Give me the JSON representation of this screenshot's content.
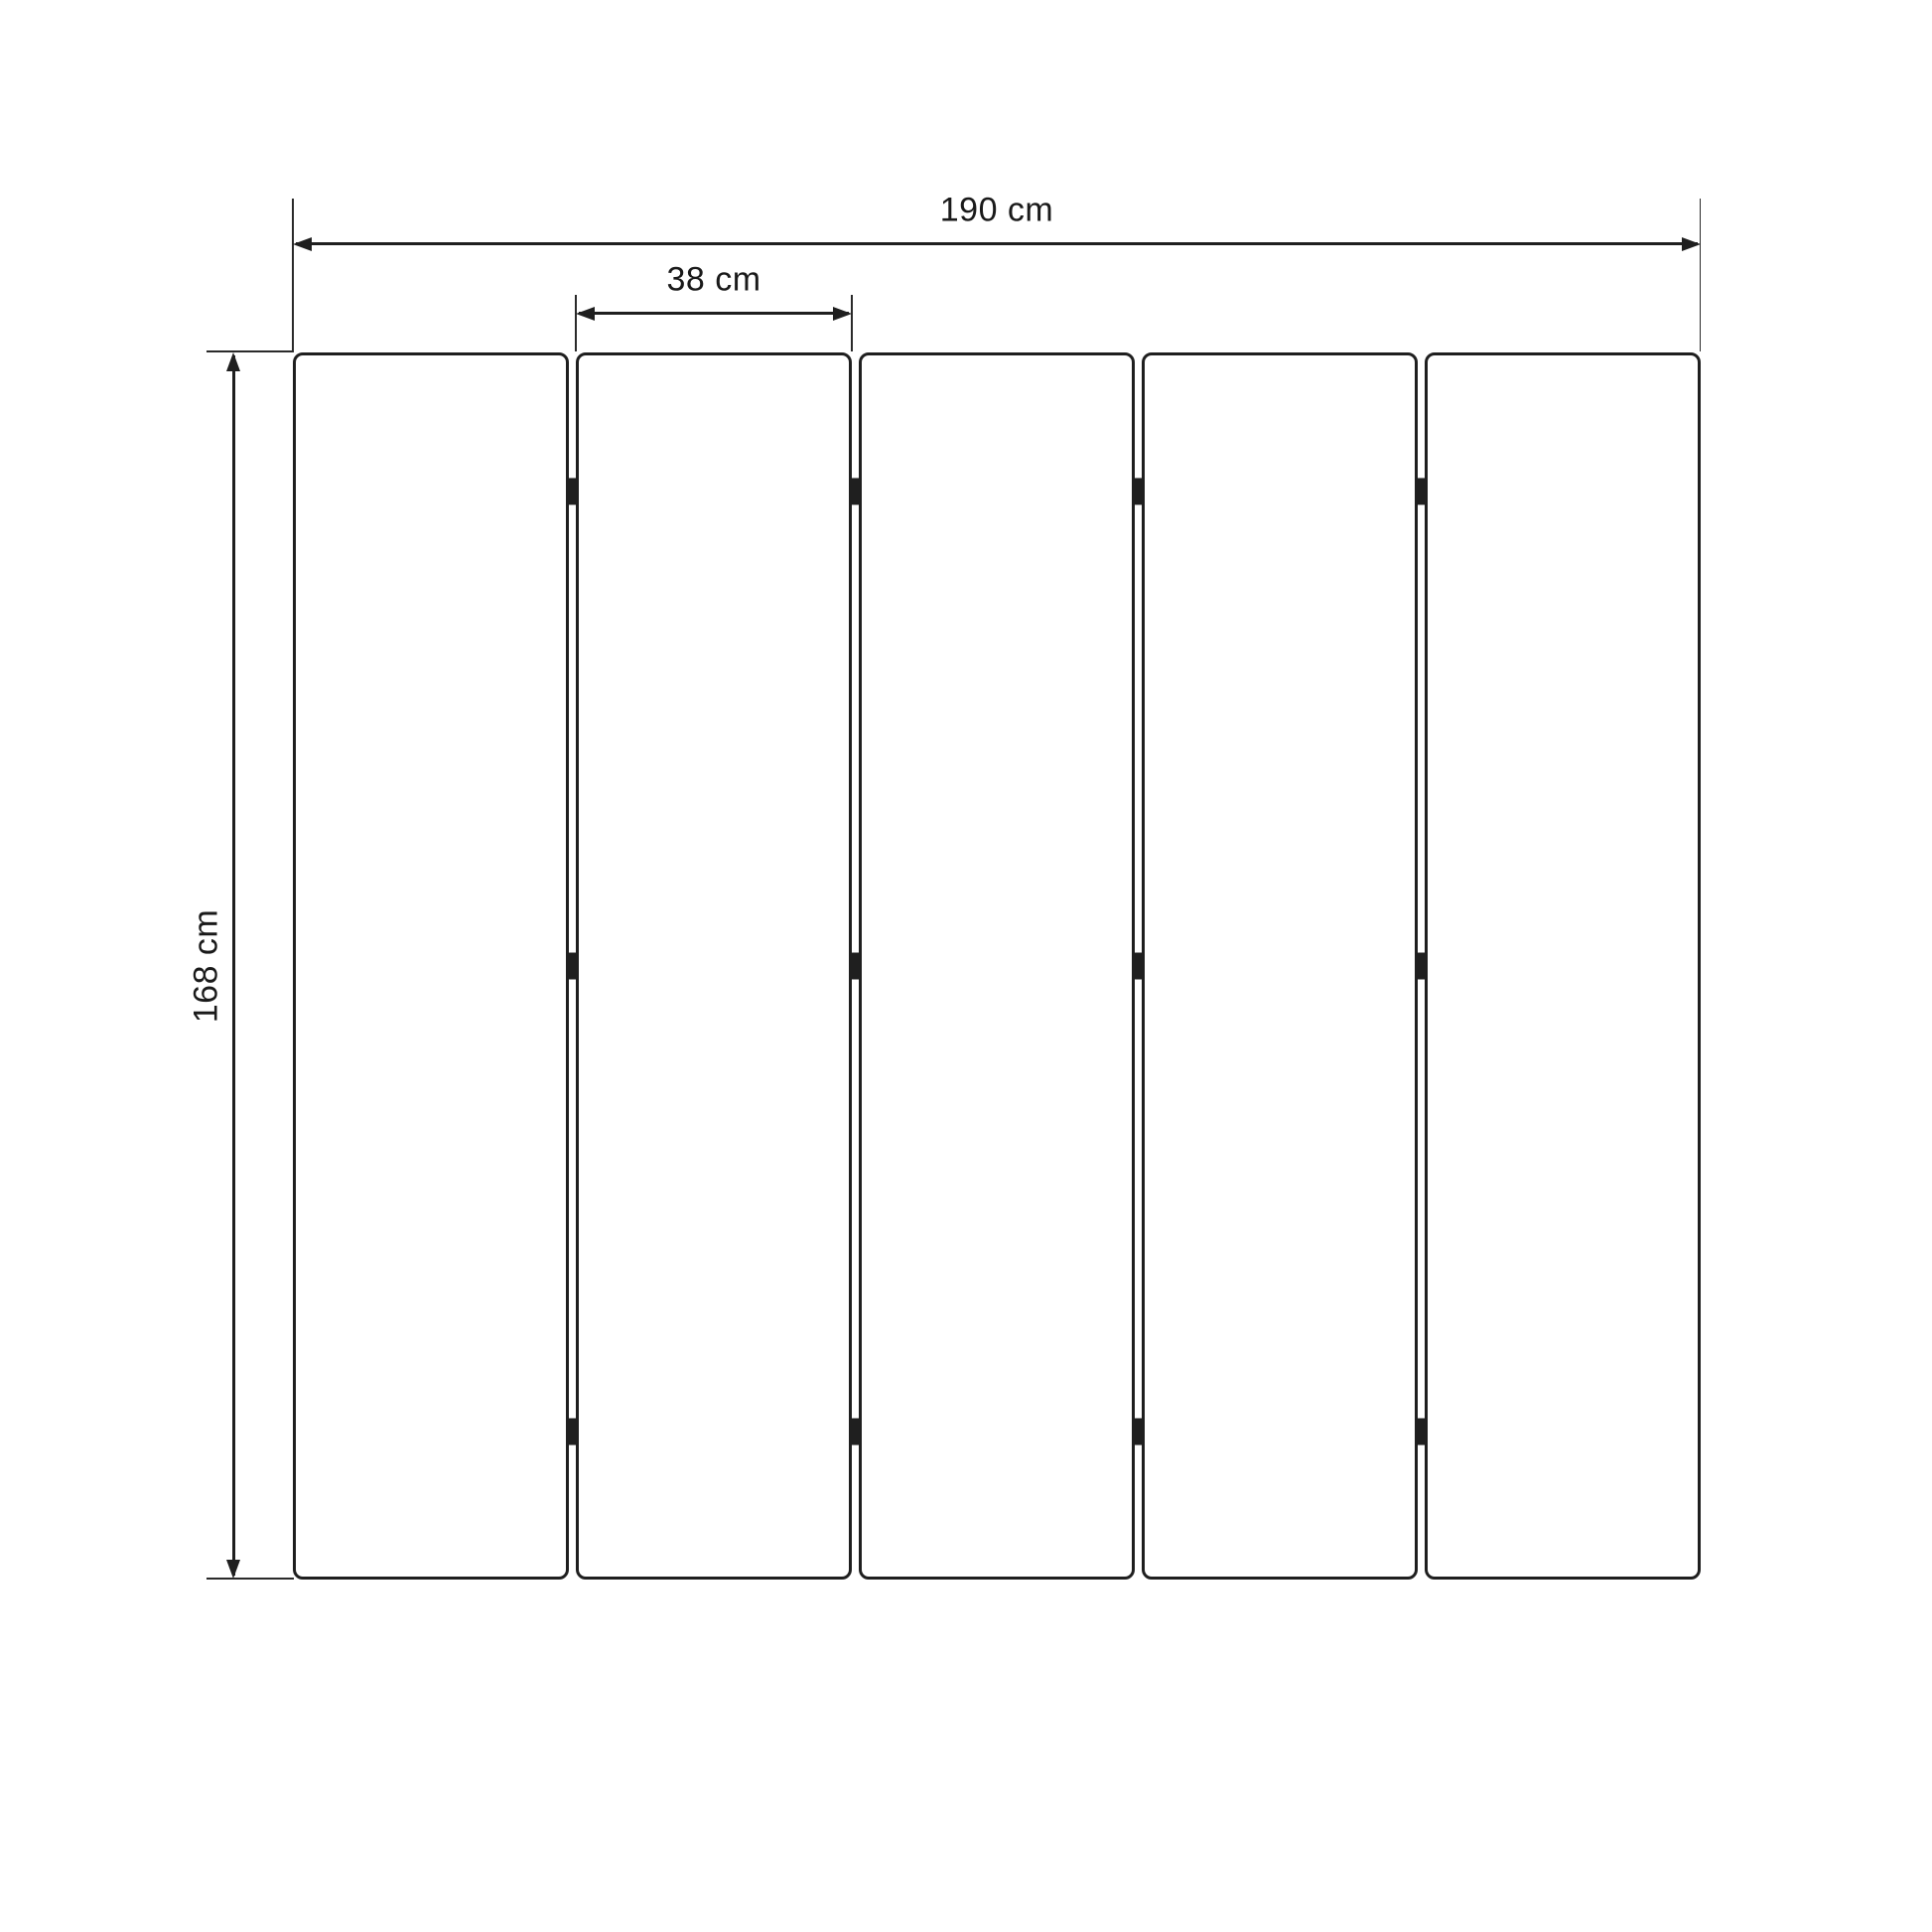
{
  "diagram": {
    "type": "dimension-diagram",
    "subject": "five-panel-folding-screen-front-view",
    "background_color": "#ffffff",
    "line_color": "#1f1f1f",
    "text_color": "#1a1a1a",
    "panel_count": 5,
    "hinge_gaps": 4,
    "hinge_rows_per_gap": 3,
    "dimensions": {
      "total_width": {
        "label": "190 cm",
        "value": 190,
        "unit": "cm",
        "orientation": "horizontal"
      },
      "panel_width": {
        "label": "38 cm",
        "value": 38,
        "unit": "cm",
        "orientation": "horizontal"
      },
      "height": {
        "label": "168 cm",
        "value": 168,
        "unit": "cm",
        "orientation": "vertical"
      }
    }
  }
}
